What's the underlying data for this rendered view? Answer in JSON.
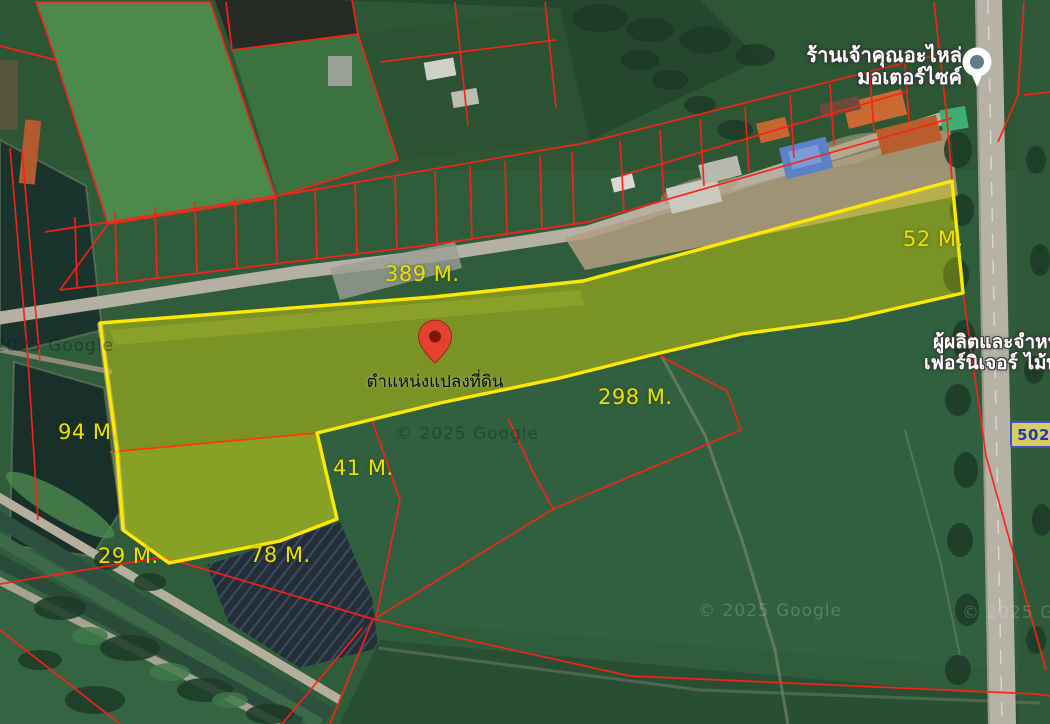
{
  "map": {
    "provider_watermark": "© 2025 Google",
    "pin": {
      "label": "ตำแหน่งแปลงที่ดิน"
    },
    "poi_shop": {
      "line1": "ร้านเจ้าคุณอะไหล่",
      "line2": "มอเตอร์ไซค์"
    },
    "poi_furniture": {
      "line1": "ผู้ผลิตและจำหน่า",
      "line2": "เฟอร์นิเจอร์ ไม้พ"
    },
    "road_badge": {
      "number": "5027"
    },
    "plot": {
      "measurements": [
        {
          "side": "top",
          "label": "389 M."
        },
        {
          "side": "right",
          "label": "52 M."
        },
        {
          "side": "bottom-strip",
          "label": "298 M."
        },
        {
          "side": "left",
          "label": "94 M."
        },
        {
          "side": "inner-right",
          "label": "41 M."
        },
        {
          "side": "bottom-left",
          "label": "29 M."
        },
        {
          "side": "bottom",
          "label": "78 M."
        }
      ]
    },
    "colors": {
      "plot_outline": "#ffe800",
      "plot_fill": "rgba(232,228,0,0.30)",
      "cadastral_line": "#ff2016",
      "measure_text": "#ecdf00",
      "pin_red": "#e54130",
      "badge_blue": "#2438b8",
      "badge_fill": "#d9cc62"
    }
  }
}
